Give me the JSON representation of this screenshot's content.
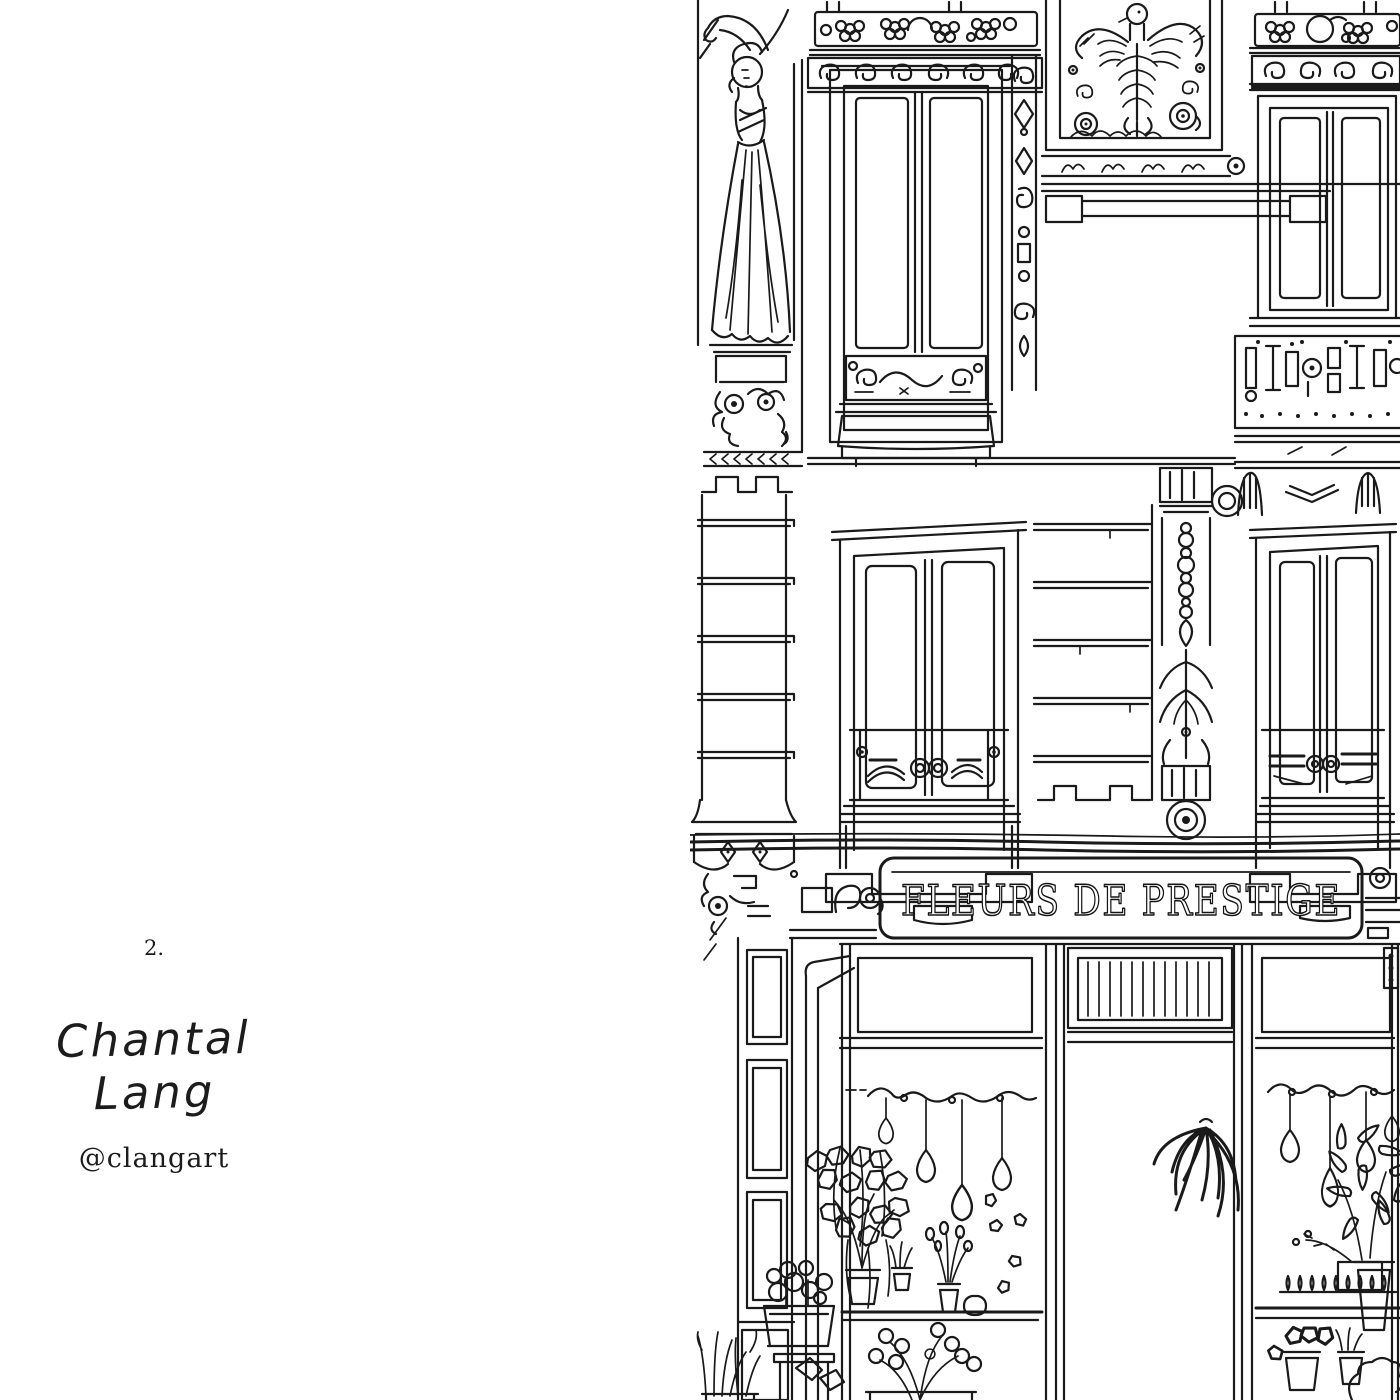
{
  "page": {
    "background_color": "#ffffff",
    "ink_color": "#1a1a1a"
  },
  "credit": {
    "page_number": "2.",
    "artist_name": "Chantal Lang",
    "artist_handle": "@clangart"
  },
  "illustration": {
    "alt": "Hand-drawn black ink illustration of a Parisian building facade: a caryatid statue, ornate French windows with wrought-iron balconies, a winged griffin relief, carved friezes, and at street level a flower shop with pendant light bulbs, hanging plants and potted flowers",
    "sign_text": "FLEURS DE PRESTIGE",
    "elements": [
      "caryatid-statue",
      "flower-balustrade",
      "upper-left-window",
      "griffin-relief-panel",
      "upper-right-window",
      "balcony-railing-band",
      "rusticated-pillar",
      "middle-left-window",
      "ornamental-pilaster",
      "middle-right-window",
      "shop-sign",
      "shop-door",
      "pendant-lights",
      "hanging-ivy-plant",
      "spider-plant",
      "pothos-plant",
      "flower-pots"
    ]
  }
}
